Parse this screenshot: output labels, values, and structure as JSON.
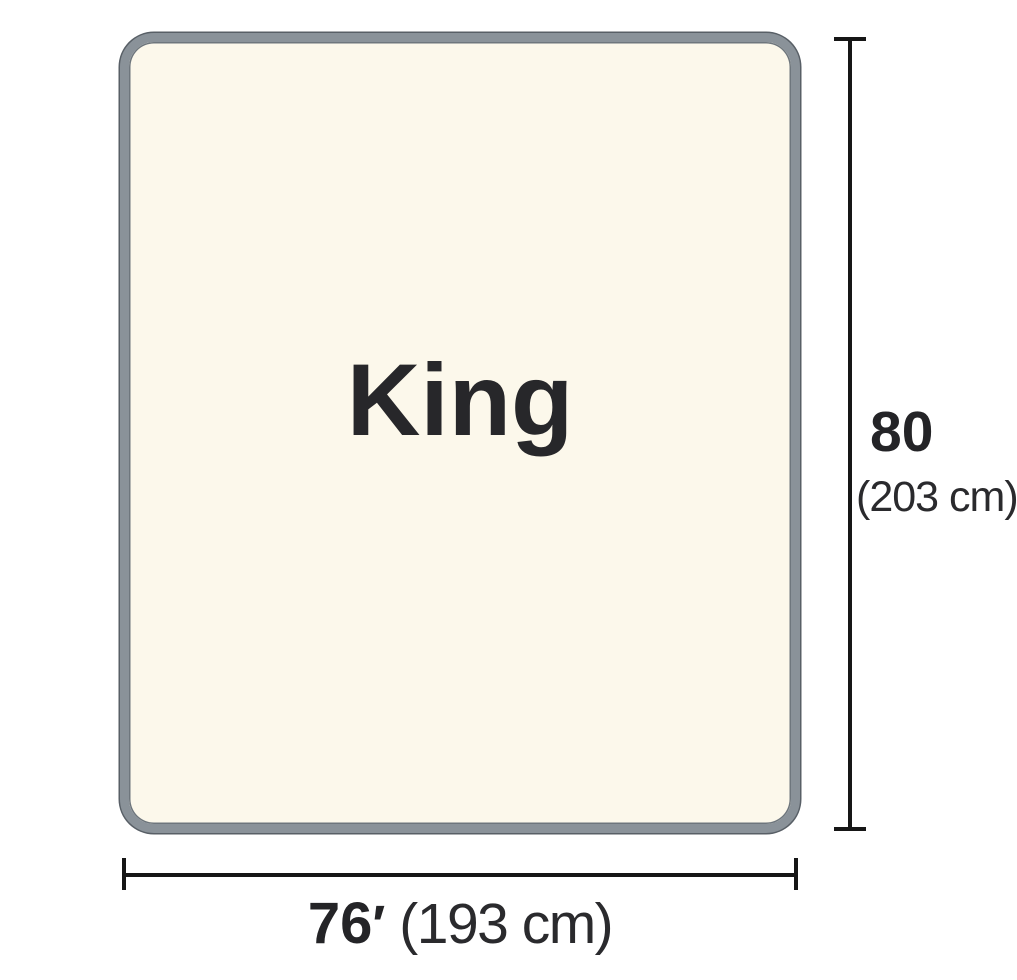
{
  "diagram": {
    "title": "Mattress size diagram",
    "size_name": "King",
    "height_dimension": {
      "value": "80",
      "metric": "(203 cm)"
    },
    "width_dimension": {
      "value": "76",
      "unit_mark": "′",
      "metric": "(193 cm)"
    },
    "colors": {
      "background": "#ffffff",
      "mattress_fill": "#fcf8eb",
      "mattress_border": "#8a9299",
      "mattress_border_edge": "#585f66",
      "dimension_line": "#161616",
      "text": "#242427"
    }
  }
}
